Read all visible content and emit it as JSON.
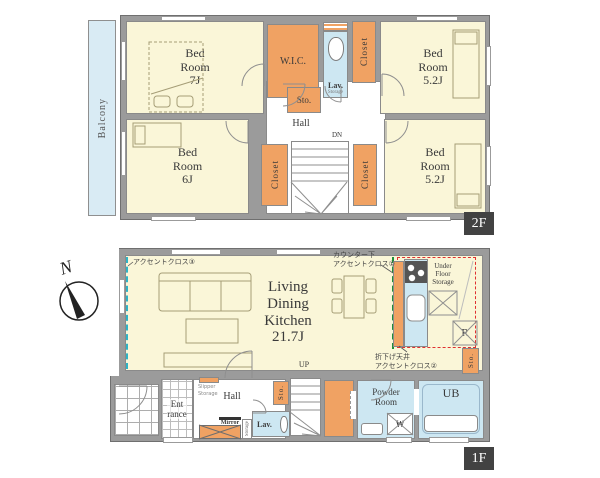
{
  "colors": {
    "wall_gray": "#9b9b9b",
    "room_yellow": "#faf6d8",
    "storage_orange": "#f0a263",
    "water_blue": "#cde7f2",
    "balcony_blue": "#d9ebf4",
    "badge_dark": "#424242",
    "accent_red_dash": "#e03030",
    "accent_green_dash": "#1f8f3a",
    "accent_teal_dash": "#2fb3c6"
  },
  "floor2": {
    "badge": "2F",
    "balcony": "Balcony",
    "bedroom7": "Bed\nRoom\n7J",
    "wic": "W.I.C.",
    "lav": "Lav.",
    "lav_storage": "Storage",
    "closet_top": "Closet",
    "bedroom52_top": "Bed\nRoom\n5.2J",
    "sto": "Sto.",
    "hall": "Hall",
    "dn": "DN",
    "closet_left": "Closet",
    "closet_right": "Closet",
    "bedroom6": "Bed\nRoom\n6J",
    "bedroom52_bottom": "Bed\nRoom\n5.2J"
  },
  "floor1": {
    "badge": "1F",
    "compass_n": "N",
    "ldk": "Living\nDining\nKitchen\n21.7J",
    "accent_cloth_3": "アクセントクロス③",
    "accent_cloth_1": "カウンター下\nアクセントクロス①",
    "accent_cloth_2": "折下げ天井\nアクセントクロス②",
    "under_floor_storage": "Under\nFloor\nStorage",
    "refrigerator": "R",
    "sto_kitchen": "Sto.",
    "up": "UP",
    "entrance": "Ent\nrance",
    "hall": "Hall",
    "slipper_storage": "Slipper\nStorage",
    "mirror": "Mirror",
    "storage": "Storage",
    "sto_hall": "Sto.",
    "lav": "Lav.",
    "powder_room": "Powder\nRoom",
    "washer": "W",
    "ub": "UB"
  }
}
